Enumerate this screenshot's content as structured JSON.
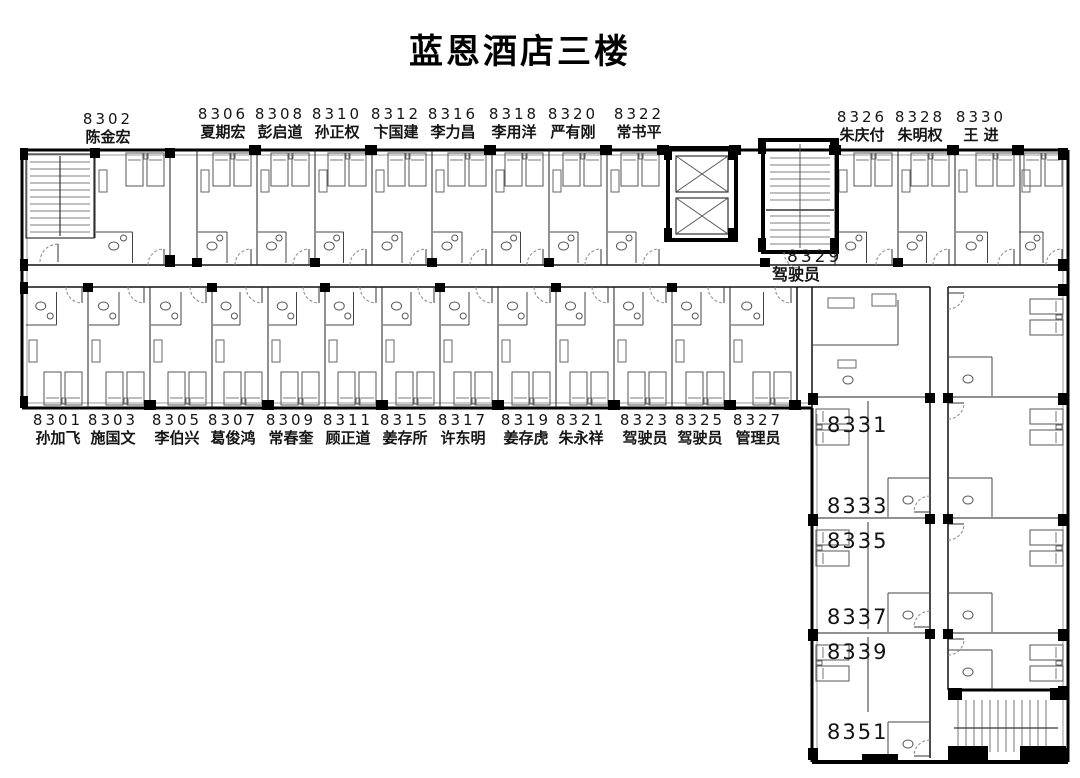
{
  "title": "蓝恩酒店三楼",
  "colors": {
    "wall": "#000000",
    "thin_line": "#555555",
    "furniture": "#666666"
  },
  "rooms": {
    "r8302": {
      "number": "8302",
      "occupant": "陈金宏"
    },
    "r8306": {
      "number": "8306",
      "occupant": "夏期宏"
    },
    "r8308": {
      "number": "8308",
      "occupant": "彭启道"
    },
    "r8310": {
      "number": "8310",
      "occupant": "孙正权"
    },
    "r8312": {
      "number": "8312",
      "occupant": "卞国建"
    },
    "r8316": {
      "number": "8316",
      "occupant": "李力昌"
    },
    "r8318": {
      "number": "8318",
      "occupant": "李用洋"
    },
    "r8320": {
      "number": "8320",
      "occupant": "严有刚"
    },
    "r8322": {
      "number": "8322",
      "occupant": "常书平"
    },
    "r8326": {
      "number": "8326",
      "occupant": "朱庆付"
    },
    "r8328": {
      "number": "8328",
      "occupant": "朱明权"
    },
    "r8330": {
      "number": "8330",
      "occupant": "王 进"
    },
    "r8329": {
      "number": "8329",
      "occupant": "驾驶员"
    },
    "r8301": {
      "number": "8301",
      "occupant": "孙加飞"
    },
    "r8303": {
      "number": "8303",
      "occupant": "施国文"
    },
    "r8305": {
      "number": "8305",
      "occupant": "李伯兴"
    },
    "r8307": {
      "number": "8307",
      "occupant": "葛俊鸿"
    },
    "r8309": {
      "number": "8309",
      "occupant": "常春奎"
    },
    "r8311": {
      "number": "8311",
      "occupant": "顾正道"
    },
    "r8315": {
      "number": "8315",
      "occupant": "姜存所"
    },
    "r8317": {
      "number": "8317",
      "occupant": "许东明"
    },
    "r8319": {
      "number": "8319",
      "occupant": "姜存虎"
    },
    "r8321": {
      "number": "8321",
      "occupant": "朱永祥"
    },
    "r8323": {
      "number": "8323",
      "occupant": "驾驶员"
    },
    "r8325": {
      "number": "8325",
      "occupant": "驾驶员"
    },
    "r8327": {
      "number": "8327",
      "occupant": "管理员"
    },
    "r8331": {
      "number": "8331"
    },
    "r8333": {
      "number": "8333"
    },
    "r8335": {
      "number": "8335"
    },
    "r8337": {
      "number": "8337"
    },
    "r8339": {
      "number": "8339"
    },
    "r8351": {
      "number": "8351"
    }
  }
}
